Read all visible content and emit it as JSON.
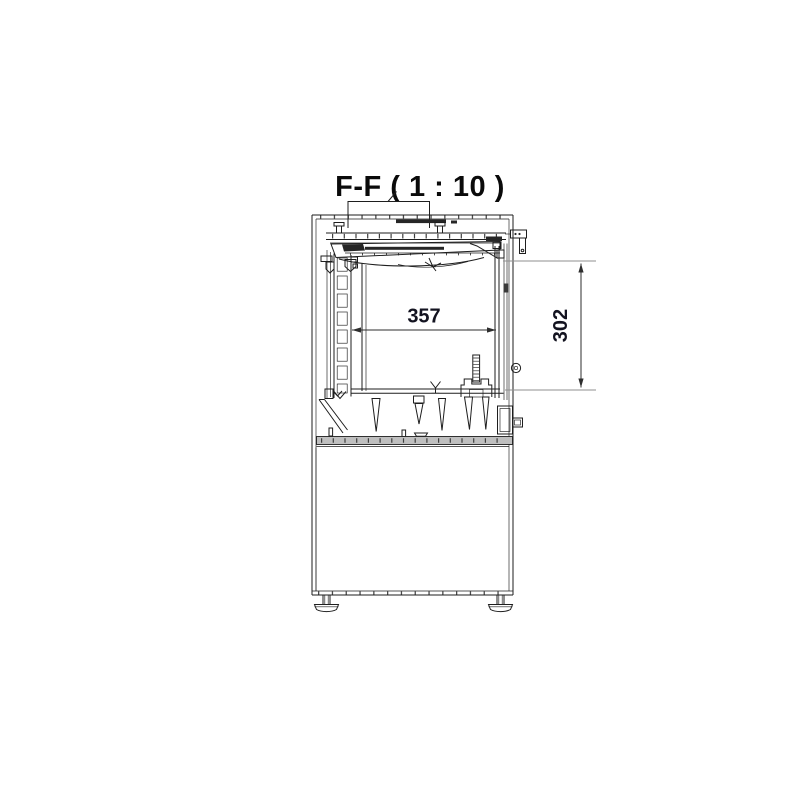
{
  "drawing": {
    "title": "F-F ( 1 : 10 )",
    "dimensions": {
      "width": "357",
      "height": "302"
    },
    "colors": {
      "background": "#ffffff",
      "line": "#1e1e1e",
      "ext-line": "#8f8f8f",
      "dim-line": "#2e2e2e",
      "dim-text": "#131320",
      "title-text": "#0a0a0a",
      "gray-fill": "#bfbfbf",
      "dark-fill": "#262626"
    }
  }
}
